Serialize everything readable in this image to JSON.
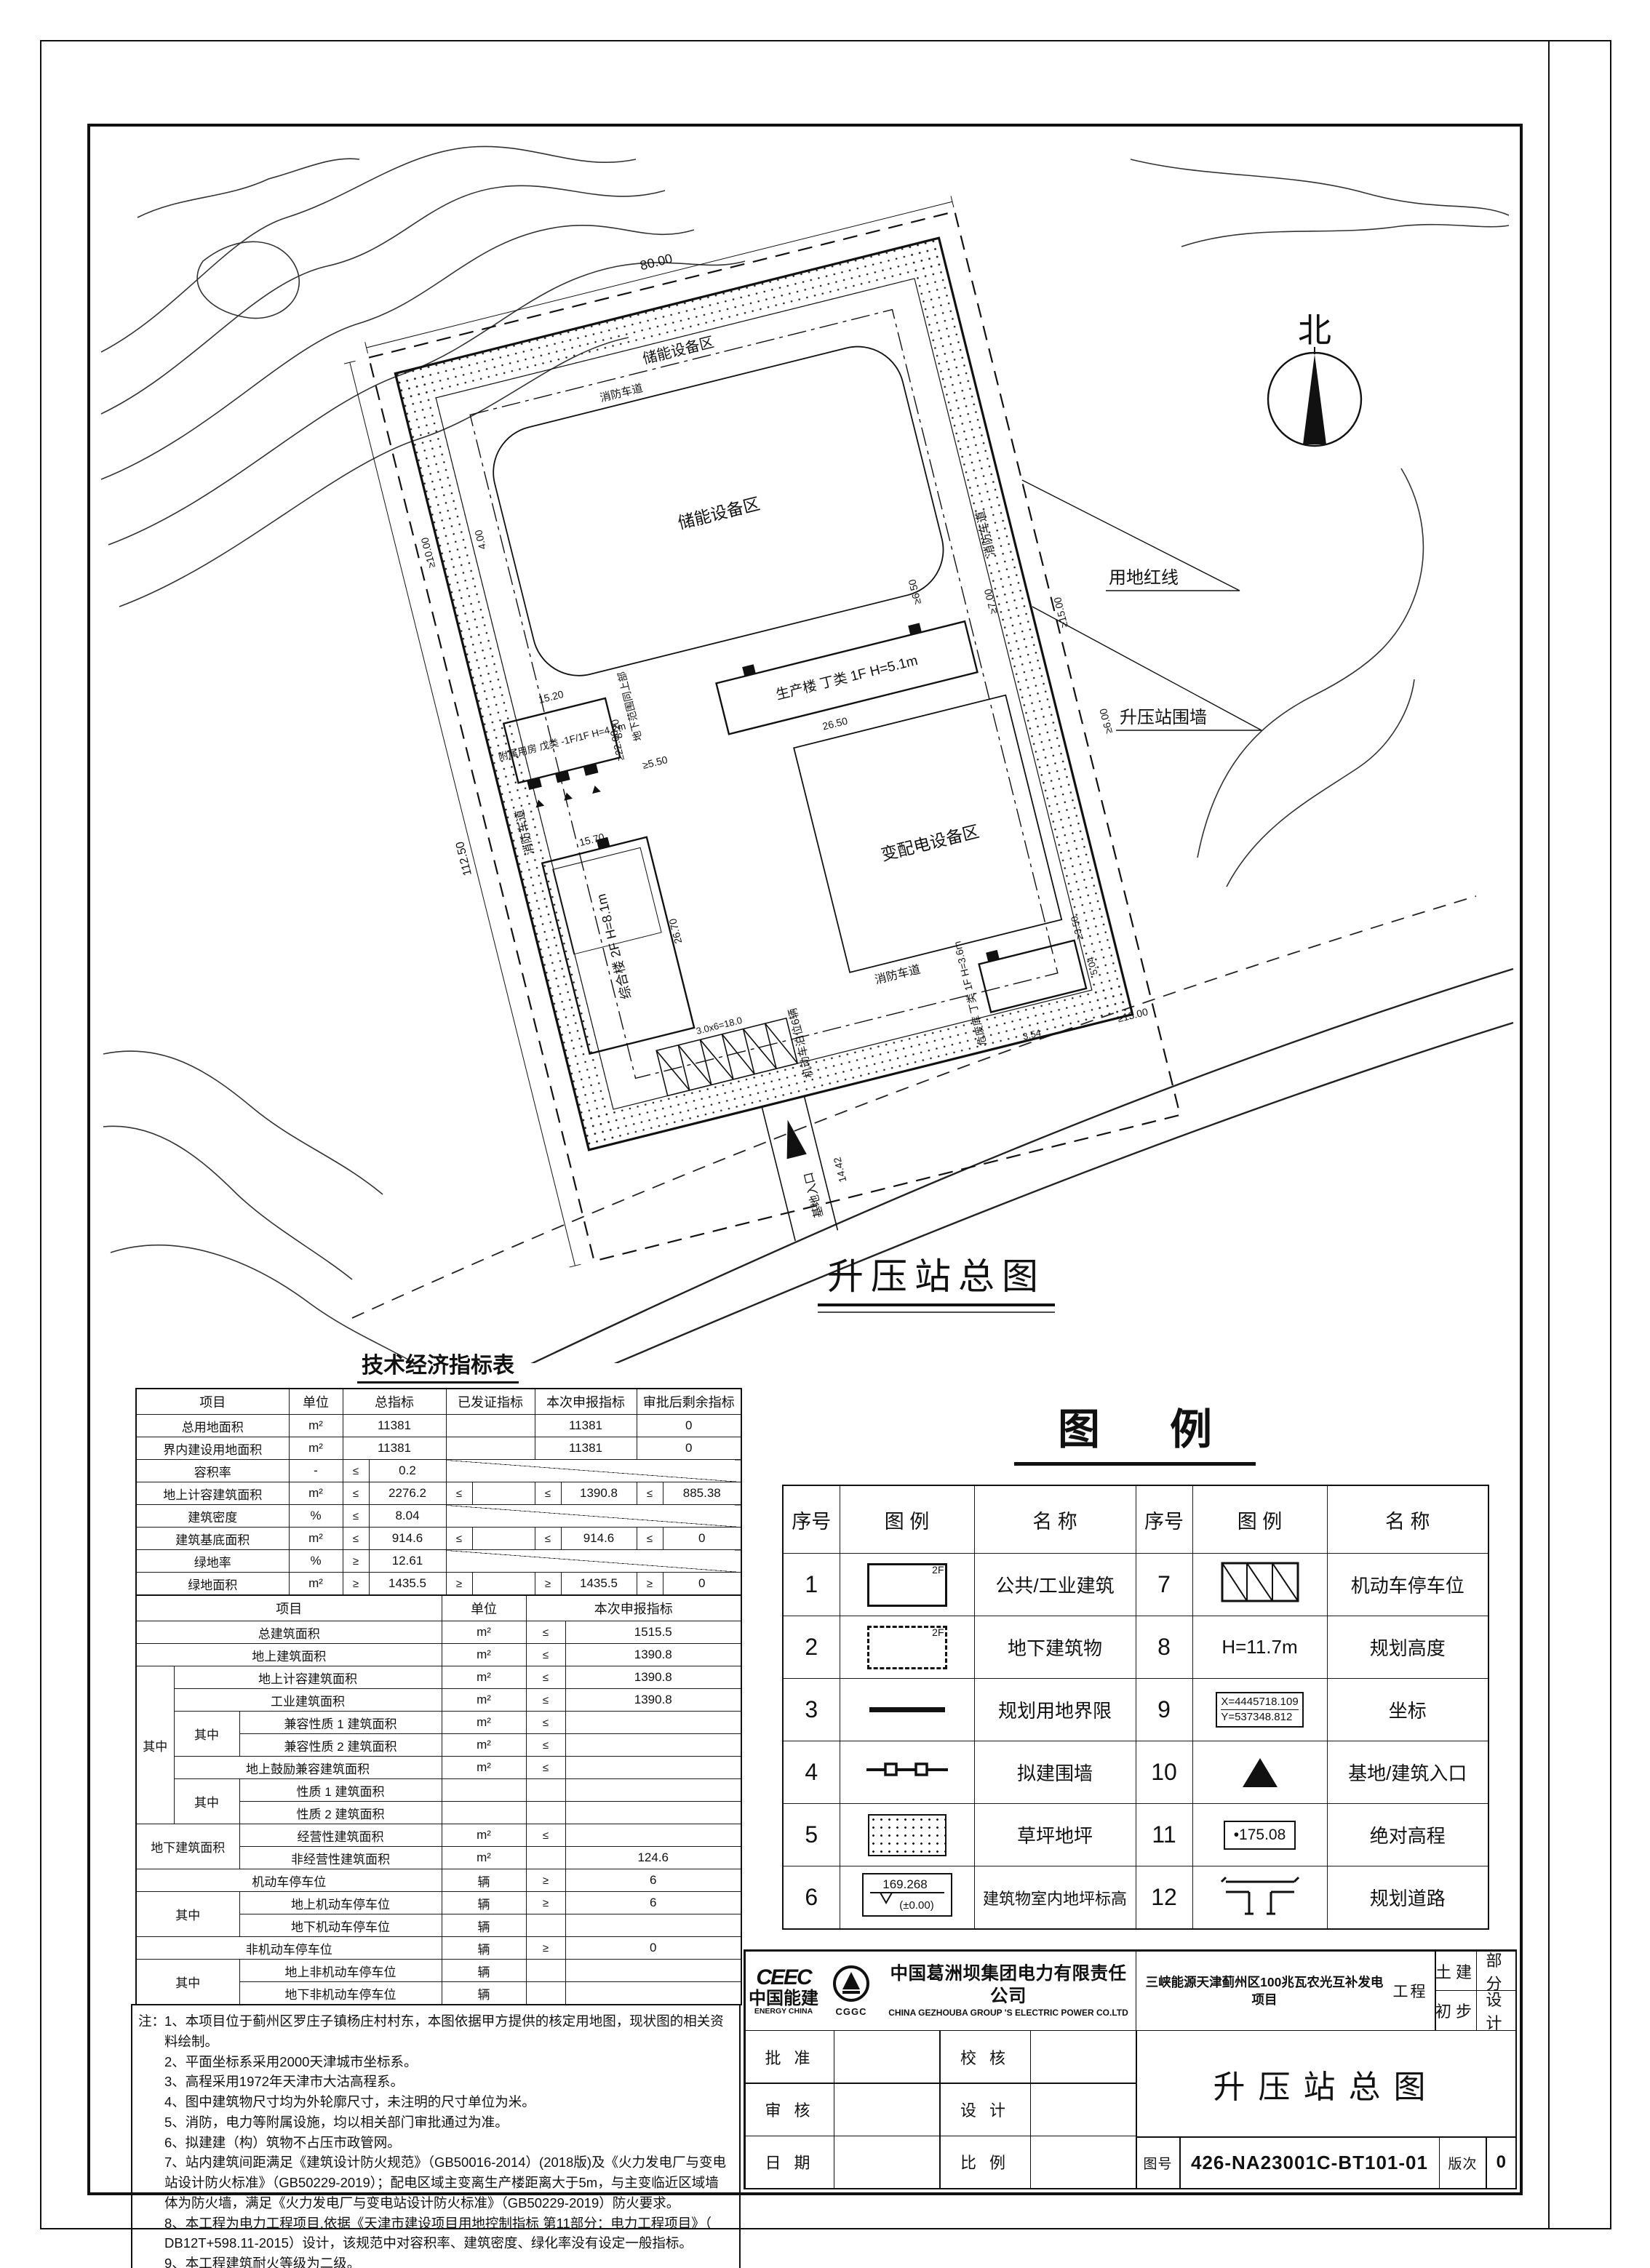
{
  "plan": {
    "title": "升压站总图",
    "north": "北",
    "labels": {
      "storage_top": "储能设备区",
      "storage": "储能设备区",
      "power": "变配电设备区",
      "production": "生产楼 丁类 1F H=5.1m",
      "auxiliary": "附属用房 戊类 -1F/1F H=4.2m",
      "composite": "综合楼 2F H=8.1m",
      "hazard": "危废库 丁类 1F H=3.6m",
      "fire_lane": "消防车道",
      "red_line": "用地红线",
      "wall": "升压站围墙",
      "underground": "地下范围同上部",
      "parking": "机动车泊位6辆",
      "entrance": "基地入口"
    },
    "dims": {
      "d80": "80.00",
      "d112": "112.50",
      "d22": "≥22.00",
      "d10": "≥10.00",
      "d400": "4.00",
      "d1520": "15.20",
      "d820": "8.20",
      "d550": "≥5.50",
      "d1570": "15.70",
      "d2670": "26.70",
      "d2650": "26.50",
      "d700": "≥7.00",
      "d650": "≥6.50",
      "d1500": "≥15.00",
      "d600": "≥6.00",
      "d350": "≥3.50",
      "d354": "3.54",
      "d504": "5.04",
      "d1300": "≥13.00",
      "d1442": "14.42",
      "dpark": "3.0x6=18.0"
    }
  },
  "econ": {
    "title": "技术经济指标表",
    "rowsA": [
      [
        {
          "t": "项目",
          "k": "head"
        },
        {
          "t": "单位",
          "k": "head"
        },
        {
          "t": "总指标",
          "cs": 2,
          "k": "head"
        },
        {
          "t": "已发证指标",
          "cs": 2,
          "k": "head"
        },
        {
          "t": "本次申报指标",
          "cs": 2,
          "k": "head"
        },
        {
          "t": "审批后剩余指标",
          "cs": 2,
          "k": "head"
        }
      ],
      [
        {
          "t": "总用地面积"
        },
        {
          "t": "m²"
        },
        {
          "t": "11381",
          "cs": 2
        },
        {
          "t": "",
          "cs": 2
        },
        {
          "t": "11381",
          "cs": 2
        },
        {
          "t": "0",
          "cs": 2
        }
      ],
      [
        {
          "t": "界内建设用地面积"
        },
        {
          "t": "m²"
        },
        {
          "t": "11381",
          "cs": 2
        },
        {
          "t": "",
          "cs": 2
        },
        {
          "t": "11381",
          "cs": 2
        },
        {
          "t": "0",
          "cs": 2
        }
      ],
      [
        {
          "t": "容积率"
        },
        {
          "t": "-"
        },
        {
          "t": "≤",
          "k": "sign"
        },
        {
          "t": "0.2"
        },
        {
          "t": "",
          "cs": 6,
          "k": "diag"
        }
      ],
      [
        {
          "t": "地上计容建筑面积"
        },
        {
          "t": "m²"
        },
        {
          "t": "≤",
          "k": "sign"
        },
        {
          "t": "2276.2"
        },
        {
          "t": "≤",
          "k": "sign"
        },
        {
          "t": ""
        },
        {
          "t": "≤",
          "k": "sign"
        },
        {
          "t": "1390.8"
        },
        {
          "t": "≤",
          "k": "sign"
        },
        {
          "t": "885.38"
        }
      ],
      [
        {
          "t": "建筑密度"
        },
        {
          "t": "%"
        },
        {
          "t": "≤",
          "k": "sign"
        },
        {
          "t": "8.04"
        },
        {
          "t": "",
          "cs": 6,
          "k": "diag"
        }
      ],
      [
        {
          "t": "建筑基底面积"
        },
        {
          "t": "m²"
        },
        {
          "t": "≤",
          "k": "sign"
        },
        {
          "t": "914.6"
        },
        {
          "t": "≤",
          "k": "sign"
        },
        {
          "t": ""
        },
        {
          "t": "≤",
          "k": "sign"
        },
        {
          "t": "914.6"
        },
        {
          "t": "≤",
          "k": "sign"
        },
        {
          "t": "0"
        }
      ],
      [
        {
          "t": "绿地率"
        },
        {
          "t": "%"
        },
        {
          "t": "≥",
          "k": "sign"
        },
        {
          "t": "12.61"
        },
        {
          "t": "",
          "cs": 6,
          "k": "diag"
        }
      ],
      [
        {
          "t": "绿地面积"
        },
        {
          "t": "m²"
        },
        {
          "t": "≥",
          "k": "sign"
        },
        {
          "t": "1435.5"
        },
        {
          "t": "≥",
          "k": "sign"
        },
        {
          "t": ""
        },
        {
          "t": "≥",
          "k": "sign"
        },
        {
          "t": "1435.5"
        },
        {
          "t": "≥",
          "k": "sign"
        },
        {
          "t": "0"
        }
      ]
    ],
    "rowsB": [
      [
        {
          "t": "项目",
          "cs": 3,
          "k": "head"
        },
        {
          "t": "单位",
          "k": "head"
        },
        {
          "t": "本次申报指标",
          "cs": 2,
          "k": "head"
        }
      ],
      [
        {
          "t": "总建筑面积",
          "cs": 3
        },
        {
          "t": "m²"
        },
        {
          "t": "≤",
          "k": "sign"
        },
        {
          "t": "1515.5"
        }
      ],
      [
        {
          "t": "地上建筑面积",
          "cs": 3
        },
        {
          "t": "m²"
        },
        {
          "t": "≤",
          "k": "sign"
        },
        {
          "t": "1390.8"
        }
      ],
      [
        {
          "t": "其中",
          "rs": 7
        },
        {
          "t": "地上计容建筑面积",
          "cs": 2
        },
        {
          "t": "m²"
        },
        {
          "t": "≤",
          "k": "sign"
        },
        {
          "t": "1390.8"
        }
      ],
      [
        {
          "t": "工业建筑面积",
          "cs": 2
        },
        {
          "t": "m²"
        },
        {
          "t": "≤",
          "k": "sign"
        },
        {
          "t": "1390.8"
        }
      ],
      [
        {
          "t": "其中",
          "rs": 2
        },
        {
          "t": "兼容性质 1 建筑面积"
        },
        {
          "t": "m²"
        },
        {
          "t": "≤",
          "k": "sign"
        },
        {
          "t": ""
        }
      ],
      [
        {
          "t": "兼容性质 2 建筑面积"
        },
        {
          "t": "m²"
        },
        {
          "t": "≤",
          "k": "sign"
        },
        {
          "t": ""
        }
      ],
      [
        {
          "t": "地上鼓励兼容建筑面积",
          "cs": 2
        },
        {
          "t": "m²"
        },
        {
          "t": "≤",
          "k": "sign"
        },
        {
          "t": ""
        }
      ],
      [
        {
          "t": "其中",
          "rs": 2
        },
        {
          "t": "性质 1 建筑面积"
        },
        {
          "t": ""
        },
        {
          "t": "",
          "k": "sign"
        },
        {
          "t": ""
        }
      ],
      [
        {
          "t": "性质 2 建筑面积"
        },
        {
          "t": ""
        },
        {
          "t": "",
          "k": "sign"
        },
        {
          "t": ""
        }
      ],
      [
        {
          "t": "地下建筑面积",
          "cs": 2,
          "rs": 2
        },
        {
          "t": "经营性建筑面积"
        },
        {
          "t": "m²"
        },
        {
          "t": "≤",
          "k": "sign"
        },
        {
          "t": ""
        }
      ],
      [
        {
          "t": "非经营性建筑面积"
        },
        {
          "t": "m²"
        },
        {
          "t": "",
          "k": "sign"
        },
        {
          "t": "124.6"
        }
      ],
      [
        {
          "t": "机动车停车位",
          "cs": 3
        },
        {
          "t": "辆"
        },
        {
          "t": "≥",
          "k": "sign"
        },
        {
          "t": "6"
        }
      ],
      [
        {
          "t": "其中",
          "rs": 2,
          "cs": 2
        },
        {
          "t": "地上机动车停车位"
        },
        {
          "t": "辆"
        },
        {
          "t": "≥",
          "k": "sign"
        },
        {
          "t": "6"
        }
      ],
      [
        {
          "t": "地下机动车停车位"
        },
        {
          "t": "辆"
        },
        {
          "t": "",
          "k": "sign"
        },
        {
          "t": ""
        }
      ],
      [
        {
          "t": "非机动车停车位",
          "cs": 3
        },
        {
          "t": "辆"
        },
        {
          "t": "≥",
          "k": "sign"
        },
        {
          "t": "0"
        }
      ],
      [
        {
          "t": "其中",
          "rs": 2,
          "cs": 2
        },
        {
          "t": "地上非机动车停车位"
        },
        {
          "t": "辆"
        },
        {
          "t": "",
          "k": "sign"
        },
        {
          "t": ""
        }
      ],
      [
        {
          "t": "地下非机动车停车位"
        },
        {
          "t": "辆"
        },
        {
          "t": "",
          "k": "sign"
        },
        {
          "t": ""
        }
      ]
    ]
  },
  "notes": {
    "label": "注：",
    "items": [
      "1、本项目位于蓟州区罗庄子镇杨庄村村东，本图依据甲方提供的核定用地图，现状图的相关资料绘制。",
      "2、平面坐标系采用2000天津城市坐标系。",
      "3、高程采用1972年天津市大沽高程系。",
      "4、图中建筑物尺寸均为外轮廓尺寸，未注明的尺寸单位为米。",
      "5、消防，电力等附属设施，均以相关部门审批通过为准。",
      "6、拟建建（构）筑物不占压市政管网。",
      "7、站内建筑间距满足《建筑设计防火规范》（GB50016-2014）(2018版)及《火力发电厂与变电站设计防火标准》（GB50229-2019）；配电区域主变离生产楼距离大于5m，与主变临近区域墙体为防火墙，满足《火力发电厂与变电站设计防火标准》（GB50229-2019）防火要求。",
      "8、本工程为电力工程项目,依据《天津市建设项目用地控制指标 第11部分：电力工程项目》（ DB12T+598.11-2015）设计，该规范中对容积率、建筑密度、绿化率没有设定一般指标。",
      "9、本工程建筑耐火等级为二级。",
      "10、本工程围墙内除绿化、建筑物、及户外设备区域外均做地面硬化。",
      "11、本场地从北到南设1.5%坡度，雨水采用自然散排方式排放，道路外侧设0.5%坡度坡向围墙排水孔。"
    ]
  },
  "legend": {
    "title": "图 例",
    "headers": [
      "序号",
      "图 例",
      "名 称",
      "序号",
      "图 例",
      "名 称"
    ],
    "floor_tag": "2F",
    "rows": [
      {
        "n1": "1",
        "name1": "公共/工业建筑",
        "n2": "7",
        "name2": "机动车停车位"
      },
      {
        "n1": "2",
        "name1": "地下建筑物",
        "n2": "8",
        "sym2_text": "H=11.7m",
        "name2": "规划高度"
      },
      {
        "n1": "3",
        "name1": "规划用地界限",
        "n2": "9",
        "coord_x": "X=4445718.109",
        "coord_y": "Y=537348.812",
        "name2": "坐标"
      },
      {
        "n1": "4",
        "name1": "拟建围墙",
        "n2": "10",
        "name2": "基地/建筑入口"
      },
      {
        "n1": "5",
        "name1": "草坪地坪",
        "n2": "11",
        "elev": "•175.08",
        "name2": "绝对高程"
      },
      {
        "n1": "6",
        "lvl_top": "169.268",
        "lvl_bot": "(±0.00)",
        "name1": "建筑物室内地坪标高",
        "n2": "12",
        "name2": "规划道路"
      }
    ]
  },
  "titleblock": {
    "logo_mark": "CEEC",
    "logo_cn": "中国能建",
    "logo_en": "ENERGY CHINA",
    "logo_cggc": "CGGC",
    "company_cn": "中国葛洲坝集团电力有限责任公司",
    "company_en": "CHINA GEZHOUBA GROUP 'S ELECTRIC POWER CO.LTD",
    "project": "三峡能源天津蓟州区100兆瓦农光互补发电项目",
    "project_suffix": "工程",
    "part_value": "土建",
    "part_label": "部分",
    "stage_value": "初步",
    "stage_label": "设计",
    "approve": "批 准",
    "check": "校 核",
    "review": "审 核",
    "design": "设 计",
    "date": "日 期",
    "scale": "比 例",
    "drawing_title": "升压站总图",
    "fig_label": "图号",
    "fig_value": "426-NA23001C-BT101-01",
    "rev_label": "版次",
    "rev_value": "0"
  }
}
